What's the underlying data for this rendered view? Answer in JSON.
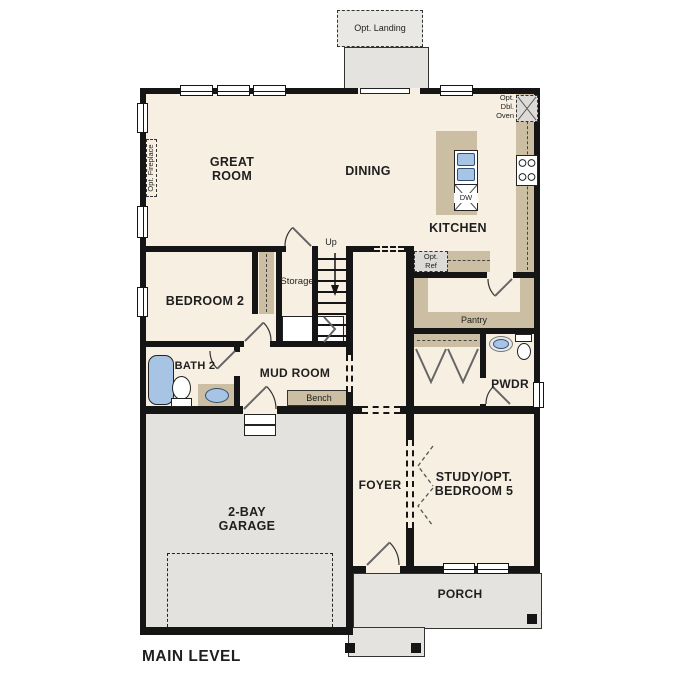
{
  "title": "MAIN LEVEL",
  "rooms": {
    "great_room": "GREAT ROOM",
    "dining": "DINING",
    "kitchen": "KITCHEN",
    "bedroom2": "BEDROOM 2",
    "bath2": "BATH 2",
    "mud_room": "MUD ROOM",
    "garage": "2-BAY GARAGE",
    "foyer": "FOYER",
    "study": "STUDY/OPT. BEDROOM 5",
    "porch": "PORCH",
    "pwdr": "PWDR",
    "pantry": "Pantry",
    "storage": "Storage"
  },
  "annotations": {
    "main_level": "MAIN LEVEL",
    "opt_landing": "Opt. Landing",
    "opt_fireplace": "Opt. Fireplace",
    "opt_dbl_oven": "Opt.\nDbl.\nOven",
    "opt_ref": "Opt.\nRef",
    "up": "Up",
    "dw": "DW",
    "bench": "Bench"
  },
  "colors": {
    "floor": "#f7efe2",
    "hardscape": "#e3e2de",
    "counter": "#cbbea2",
    "wall": "#151515",
    "fixture_blue": "#a7c4e4",
    "appliance": "#dcdbd7"
  }
}
